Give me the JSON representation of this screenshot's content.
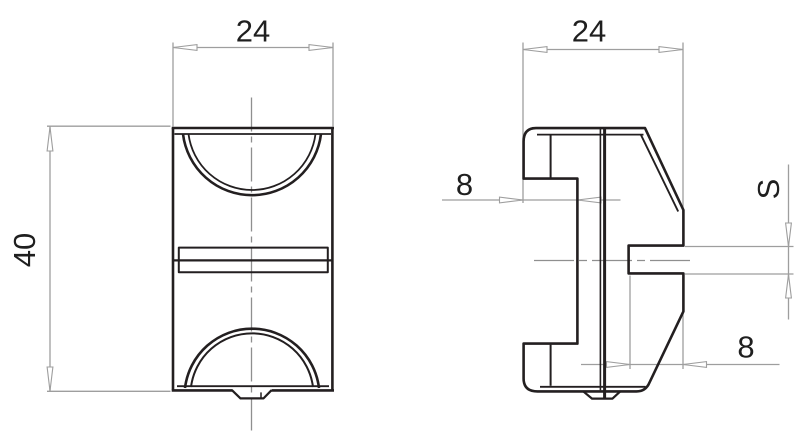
{
  "drawing": {
    "kind": "technical-drawing-two-views",
    "colors": {
      "outline": "#231f20",
      "dimension_line": "#9e9e9e",
      "centerline": "#8f8f8f",
      "text": "#1f1f1f",
      "background": "#ffffff"
    },
    "views": {
      "front": {
        "label_width": "24",
        "label_height": "40"
      },
      "side": {
        "label_width": "24",
        "label_step_depth": "8",
        "label_slot_depth": "8",
        "label_slot_width": "S"
      }
    }
  }
}
